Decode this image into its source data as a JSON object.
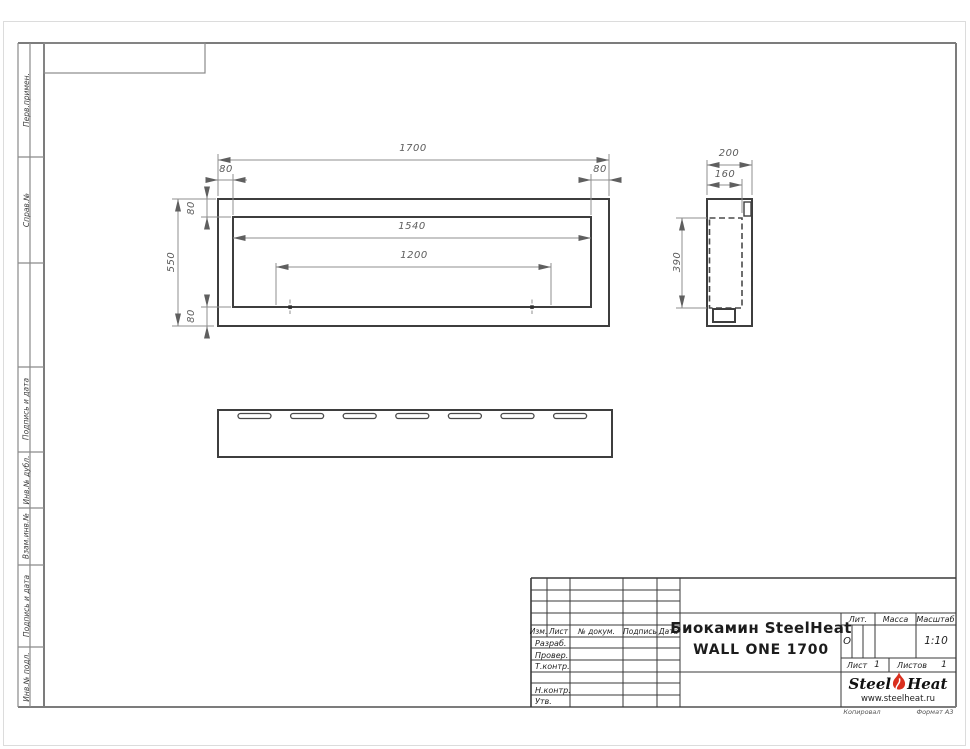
{
  "frame": {
    "side_labels_top": [
      "Перв.примен.",
      "Справ.№"
    ],
    "side_labels_bottom": [
      "Подпись и дата",
      "Инв.№ дубл.",
      "Взам.инв.№",
      "Подпись и дата",
      "Инв.№ подл."
    ],
    "kopiroval": "Копировал",
    "format": "Формат А3"
  },
  "dims": {
    "front_width": "1700",
    "front_height": "550",
    "front_inner_width": "1540",
    "front_holes_span": "1200",
    "front_inset_left": "80",
    "front_inset_right": "80",
    "front_inset_top": "80",
    "front_inset_bottom": "80",
    "side_depth": "200",
    "side_inner_depth": "160",
    "side_inner_height": "390"
  },
  "stamp": {
    "rev_cols": [
      "Изм.",
      "Лист",
      "№ докум.",
      "Подпись",
      "Дата"
    ],
    "roles": [
      "Разраб.",
      "Провер.",
      "Т.контр.",
      "Н.контр.",
      "Утв."
    ],
    "title_line1": "Биокамин SteelHeat",
    "title_line2": "WALL ONE 1700",
    "lit_label": "Лит.",
    "lit_value": "О",
    "mass_label": "Масса",
    "scale_label": "Масштаб",
    "scale_value": "1:10",
    "sheet_label": "Лист",
    "sheet_value": "1",
    "sheets_label": "Листов",
    "sheets_value": "1",
    "logo_part1": "Steel",
    "logo_part2": "Heat",
    "logo_url": "www.steelheat.ru",
    "accent_color": "#da2f1e"
  }
}
